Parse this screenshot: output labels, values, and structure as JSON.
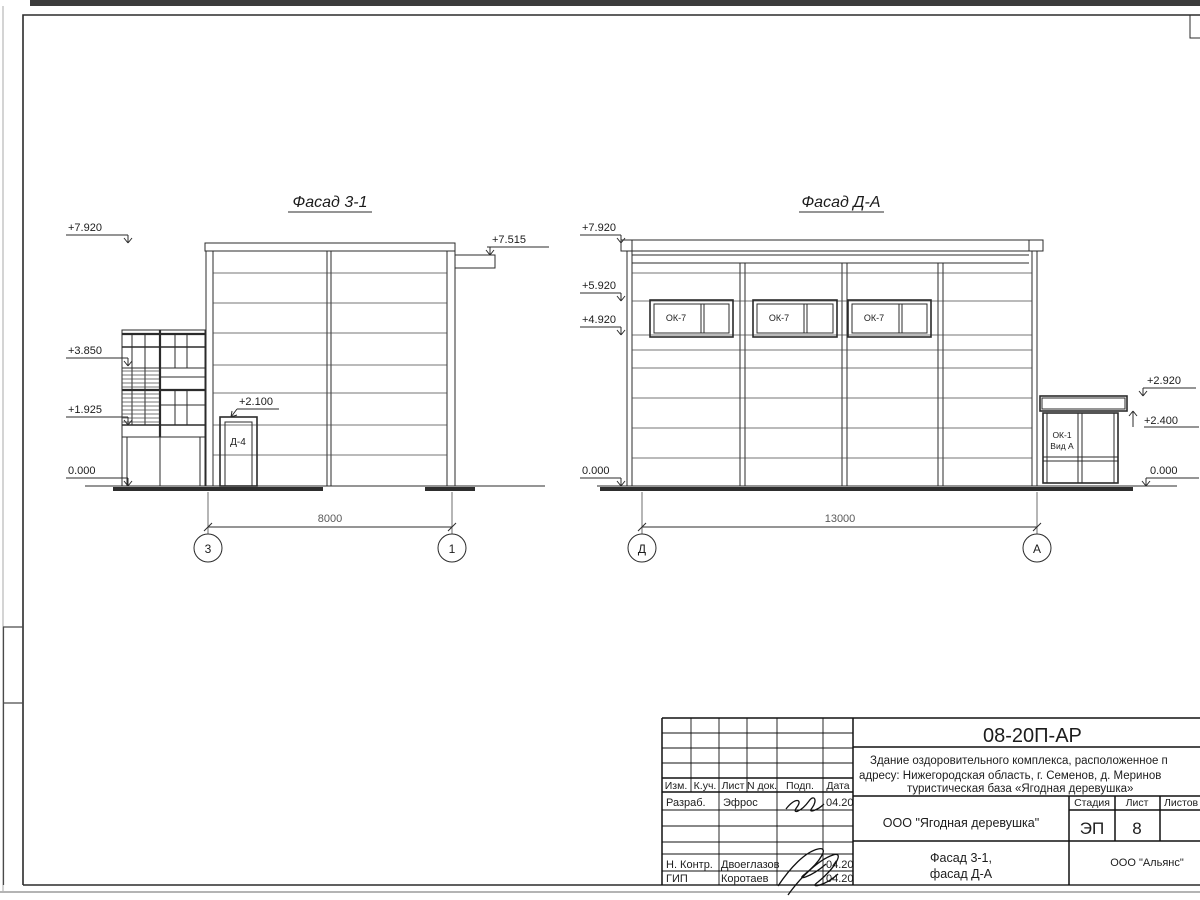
{
  "sheet": {
    "facade_left": {
      "title": "Фасад 3-1",
      "elev_top": "+7.920",
      "elev_mid": "+3.850",
      "elev_low": "+1.925",
      "elev_zero": "0.000",
      "elev_pipe": "+7.515",
      "elev_door": "+2.100",
      "door_label": "Д-4",
      "dimension": "8000",
      "grid_left": "3",
      "grid_right": "1"
    },
    "facade_right": {
      "title": "Фасад Д-А",
      "elev_top": "+7.920",
      "elev_win_head": "+5.920",
      "elev_win_sill": "+4.920",
      "elev_zero_left": "0.000",
      "elev_annex_top": "+2.920",
      "elev_annex_soffit": "+2.400",
      "elev_zero_right": "0.000",
      "windows": [
        "ОК-7",
        "ОК-7",
        "ОК-7"
      ],
      "annex_label_1": "ОК-1",
      "annex_label_2": "Вид А",
      "dimension": "13000",
      "grid_left": "Д",
      "grid_right": "А"
    },
    "title_block": {
      "doc_number": "08-20П-АР",
      "project_line1": "Здание оздоровительного комплекса, расположенное п",
      "project_line2": "адресу: Нижегородская область, г. Семенов, д. Меринов",
      "project_line3": "туристическая база «Ягодная деревушка»",
      "col_izm": "Изм.",
      "col_kuch": "К.уч.",
      "col_list": "Лист",
      "col_ndok": "N док.",
      "col_podp": "Подп.",
      "col_data": "Дата",
      "row1_role": "Разраб.",
      "row1_name": "Эфрос",
      "row1_date": "04.20",
      "row2_role": "Н. Контр.",
      "row2_name": "Двоеглазов",
      "row2_date": "04.20",
      "row3_role": "ГИП",
      "row3_name": "Коротаев",
      "row3_date": "04.20",
      "client": "ООО \"Ягодная деревушка\"",
      "stage_label": "Стадия",
      "sheet_label": "Лист",
      "sheets_label": "Листов",
      "stage_value": "ЭП",
      "sheet_value": "8",
      "sheet_title_1": "Фасад 3-1,",
      "sheet_title_2": "фасад Д-А",
      "company": "ООО \"Альянс\""
    }
  }
}
